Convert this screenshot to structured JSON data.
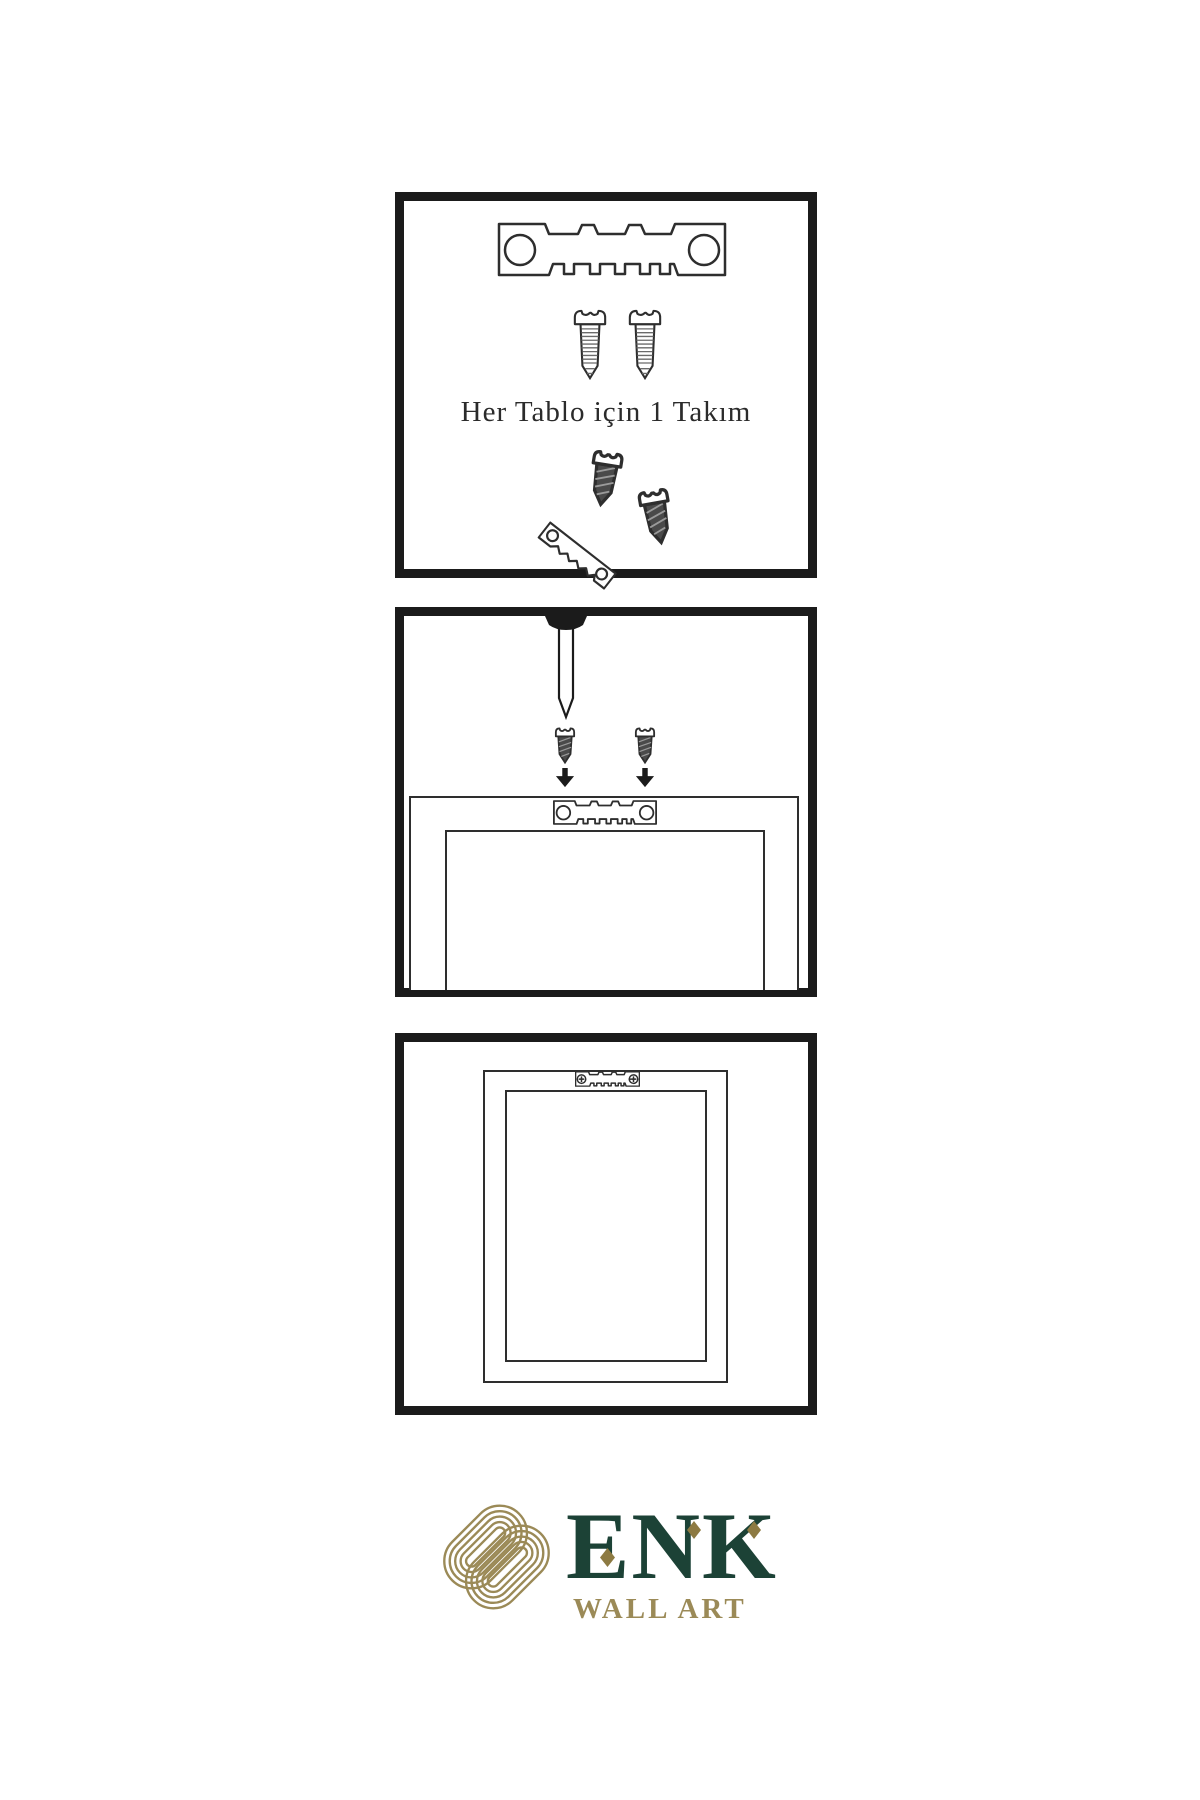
{
  "colors": {
    "line": "#1b1b1b",
    "art-line": "#2e2e2e",
    "screw-dark": "#4a4a4a",
    "gold": "#9b8a57",
    "gold-dark": "#8d7a42",
    "green": "#1c4236",
    "text": "#2b2b2b"
  },
  "sheet": {
    "step1": {
      "caption": "Her Tablo için 1 Takım",
      "icons": [
        "sawtooth-hanger-icon",
        "screw-icon",
        "screw-icon",
        "screw-icon",
        "tilted-sawtooth-hanger-icon",
        "screw-icon"
      ]
    },
    "step2": {
      "icons": [
        "nail-icon",
        "screw-icon",
        "screw-icon",
        "down-arrow-icon",
        "down-arrow-icon",
        "sawtooth-hanger-icon",
        "frame-back-icon"
      ]
    },
    "step3": {
      "icons": [
        "frame-back-icon",
        "mounted-sawtooth-hanger-icon"
      ]
    }
  },
  "logo": {
    "brand": "ENK",
    "tagline": "WALL ART",
    "emblem": "interlaced-knot-icon"
  }
}
